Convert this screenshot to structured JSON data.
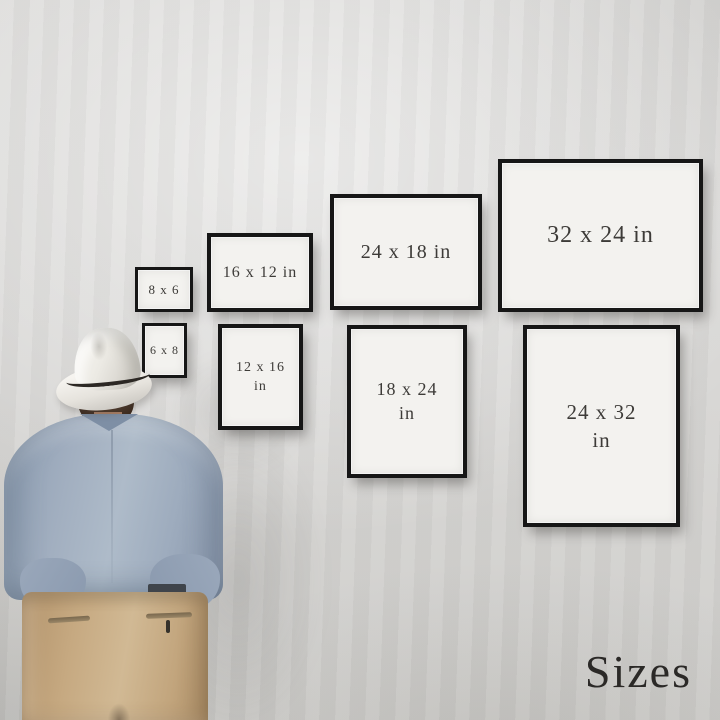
{
  "page": {
    "label": "Sizes"
  },
  "frames": [
    {
      "name": "8x6",
      "orientation": "landscape",
      "row": "top",
      "lines": [
        "8 x 6"
      ]
    },
    {
      "name": "16x12",
      "orientation": "landscape",
      "row": "top",
      "lines": [
        "16 x 12 in"
      ]
    },
    {
      "name": "24x18",
      "orientation": "landscape",
      "row": "top",
      "lines": [
        "24 x 18 in"
      ]
    },
    {
      "name": "32x24",
      "orientation": "landscape",
      "row": "top",
      "lines": [
        "32 x 24 in"
      ]
    },
    {
      "name": "6x8",
      "orientation": "portrait",
      "row": "bottom",
      "lines": [
        "6 x 8"
      ]
    },
    {
      "name": "12x16",
      "orientation": "portrait",
      "row": "bottom",
      "lines": [
        "12 x 16",
        "in"
      ]
    },
    {
      "name": "18x24",
      "orientation": "portrait",
      "row": "bottom",
      "lines": [
        "18 x 24",
        "in"
      ]
    },
    {
      "name": "24x32",
      "orientation": "portrait",
      "row": "bottom",
      "lines": [
        "24 x 32",
        "in"
      ]
    }
  ],
  "person": {
    "description": "man seen from behind wearing a white fedora with dark band, light blue shirt and khaki trousers, looking at the framed size chart"
  },
  "colors": {
    "wall": "#d9d8d6",
    "frameBlack": "#161616",
    "printWhite": "#f3f2ef",
    "printText": "#3d3b38",
    "labelText": "#2b2927",
    "hat": "#efece7",
    "hatBand": "#2c2824",
    "hair": "#44301f",
    "shirt": "#a2afc0",
    "trousers": "#c2a57d"
  }
}
